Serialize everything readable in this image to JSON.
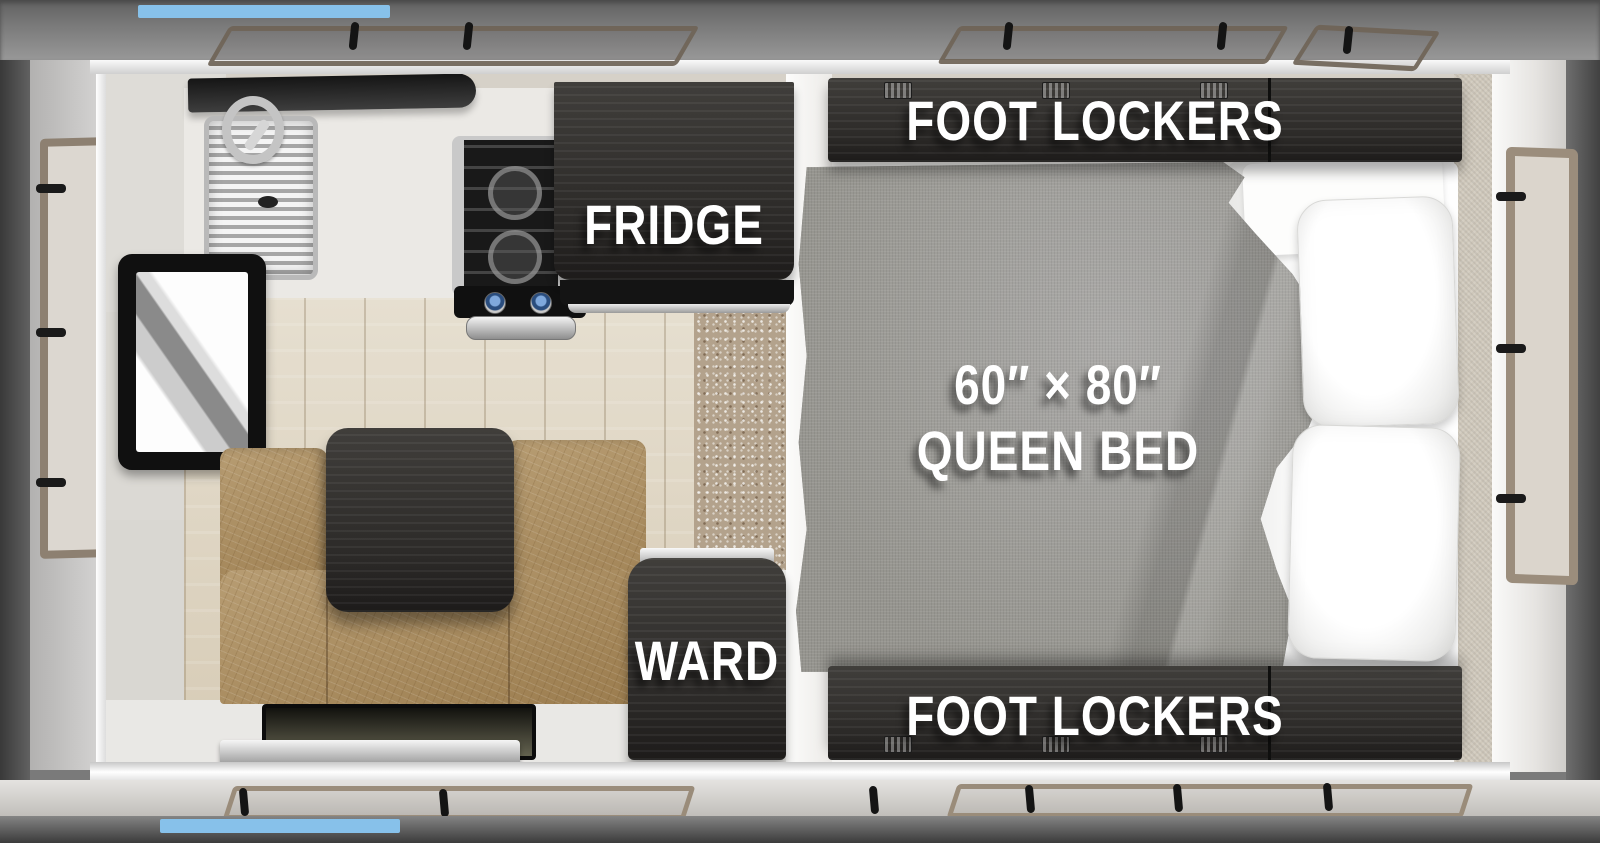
{
  "floorplan": {
    "type": "truck-camper-top-view",
    "labels": {
      "fridge": "FRIDGE",
      "wardrobe": "WARD",
      "bed_size": "60″ × 80″",
      "bed_type": "QUEEN BED",
      "foot_lockers_top": "FOOT LOCKERS",
      "foot_lockers_bottom": "FOOT LOCKERS"
    },
    "colors": {
      "accent_blue": "#87c1ea",
      "cabinet_dark": "#2c2a28",
      "cushion_tan": "#ab8c5b",
      "blanket_gray": "#a09f9d",
      "wood_floor": "#e0d8c7",
      "label_text": "#ffffff"
    }
  }
}
